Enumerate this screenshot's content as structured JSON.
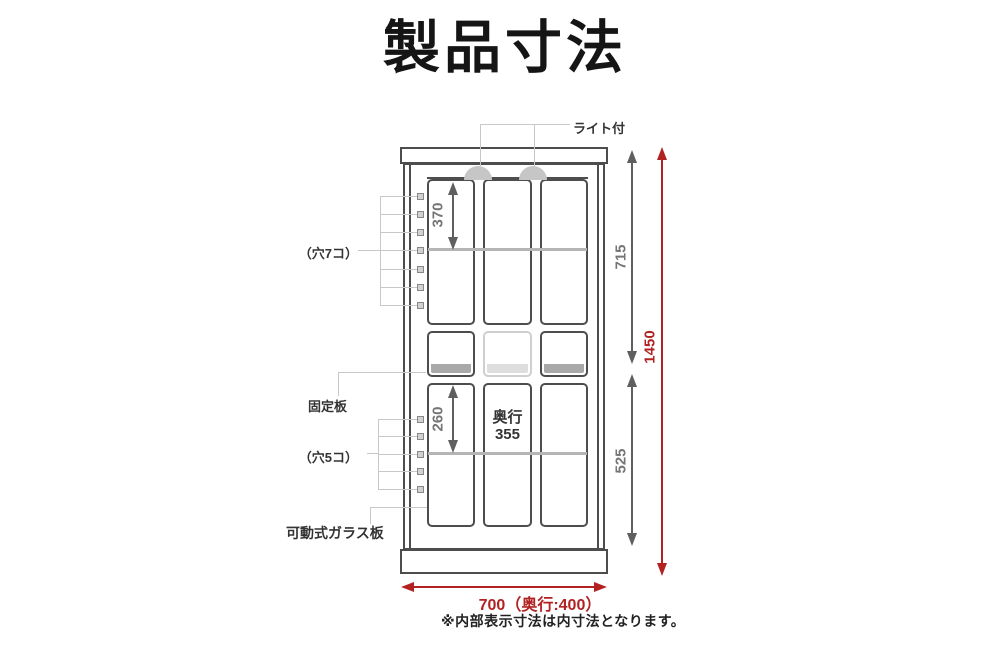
{
  "title": "製品寸法",
  "callouts": {
    "light": "ライト付",
    "holes_upper": "（穴7コ）",
    "fixed_board": "固定板",
    "holes_lower": "（穴5コ）",
    "movable_glass": "可動式ガラス板"
  },
  "dimensions": {
    "upper_shelf_pitch": "370",
    "upper_inner_height": "715",
    "overall_height": "1450",
    "lower_shelf_pitch": "260",
    "lower_inner_height": "525",
    "inner_depth_label": "奥行",
    "inner_depth_value": "355",
    "overall_width": "700（奥行:400）"
  },
  "note": "※内部表示寸法は内寸法となります。",
  "holes": {
    "upper_count": 7,
    "lower_count": 5
  },
  "colors": {
    "outline": "#4d4d4d",
    "dim_gray": "#5f5f5f",
    "dim_text_gray": "#757575",
    "dim_red": "#b22222",
    "leader_gray": "#c8c8c8",
    "shelf_gray": "#b5b5b5",
    "fixed_shelf_fill": "#a9a9a9",
    "light_fill": "#c6c6c6"
  }
}
